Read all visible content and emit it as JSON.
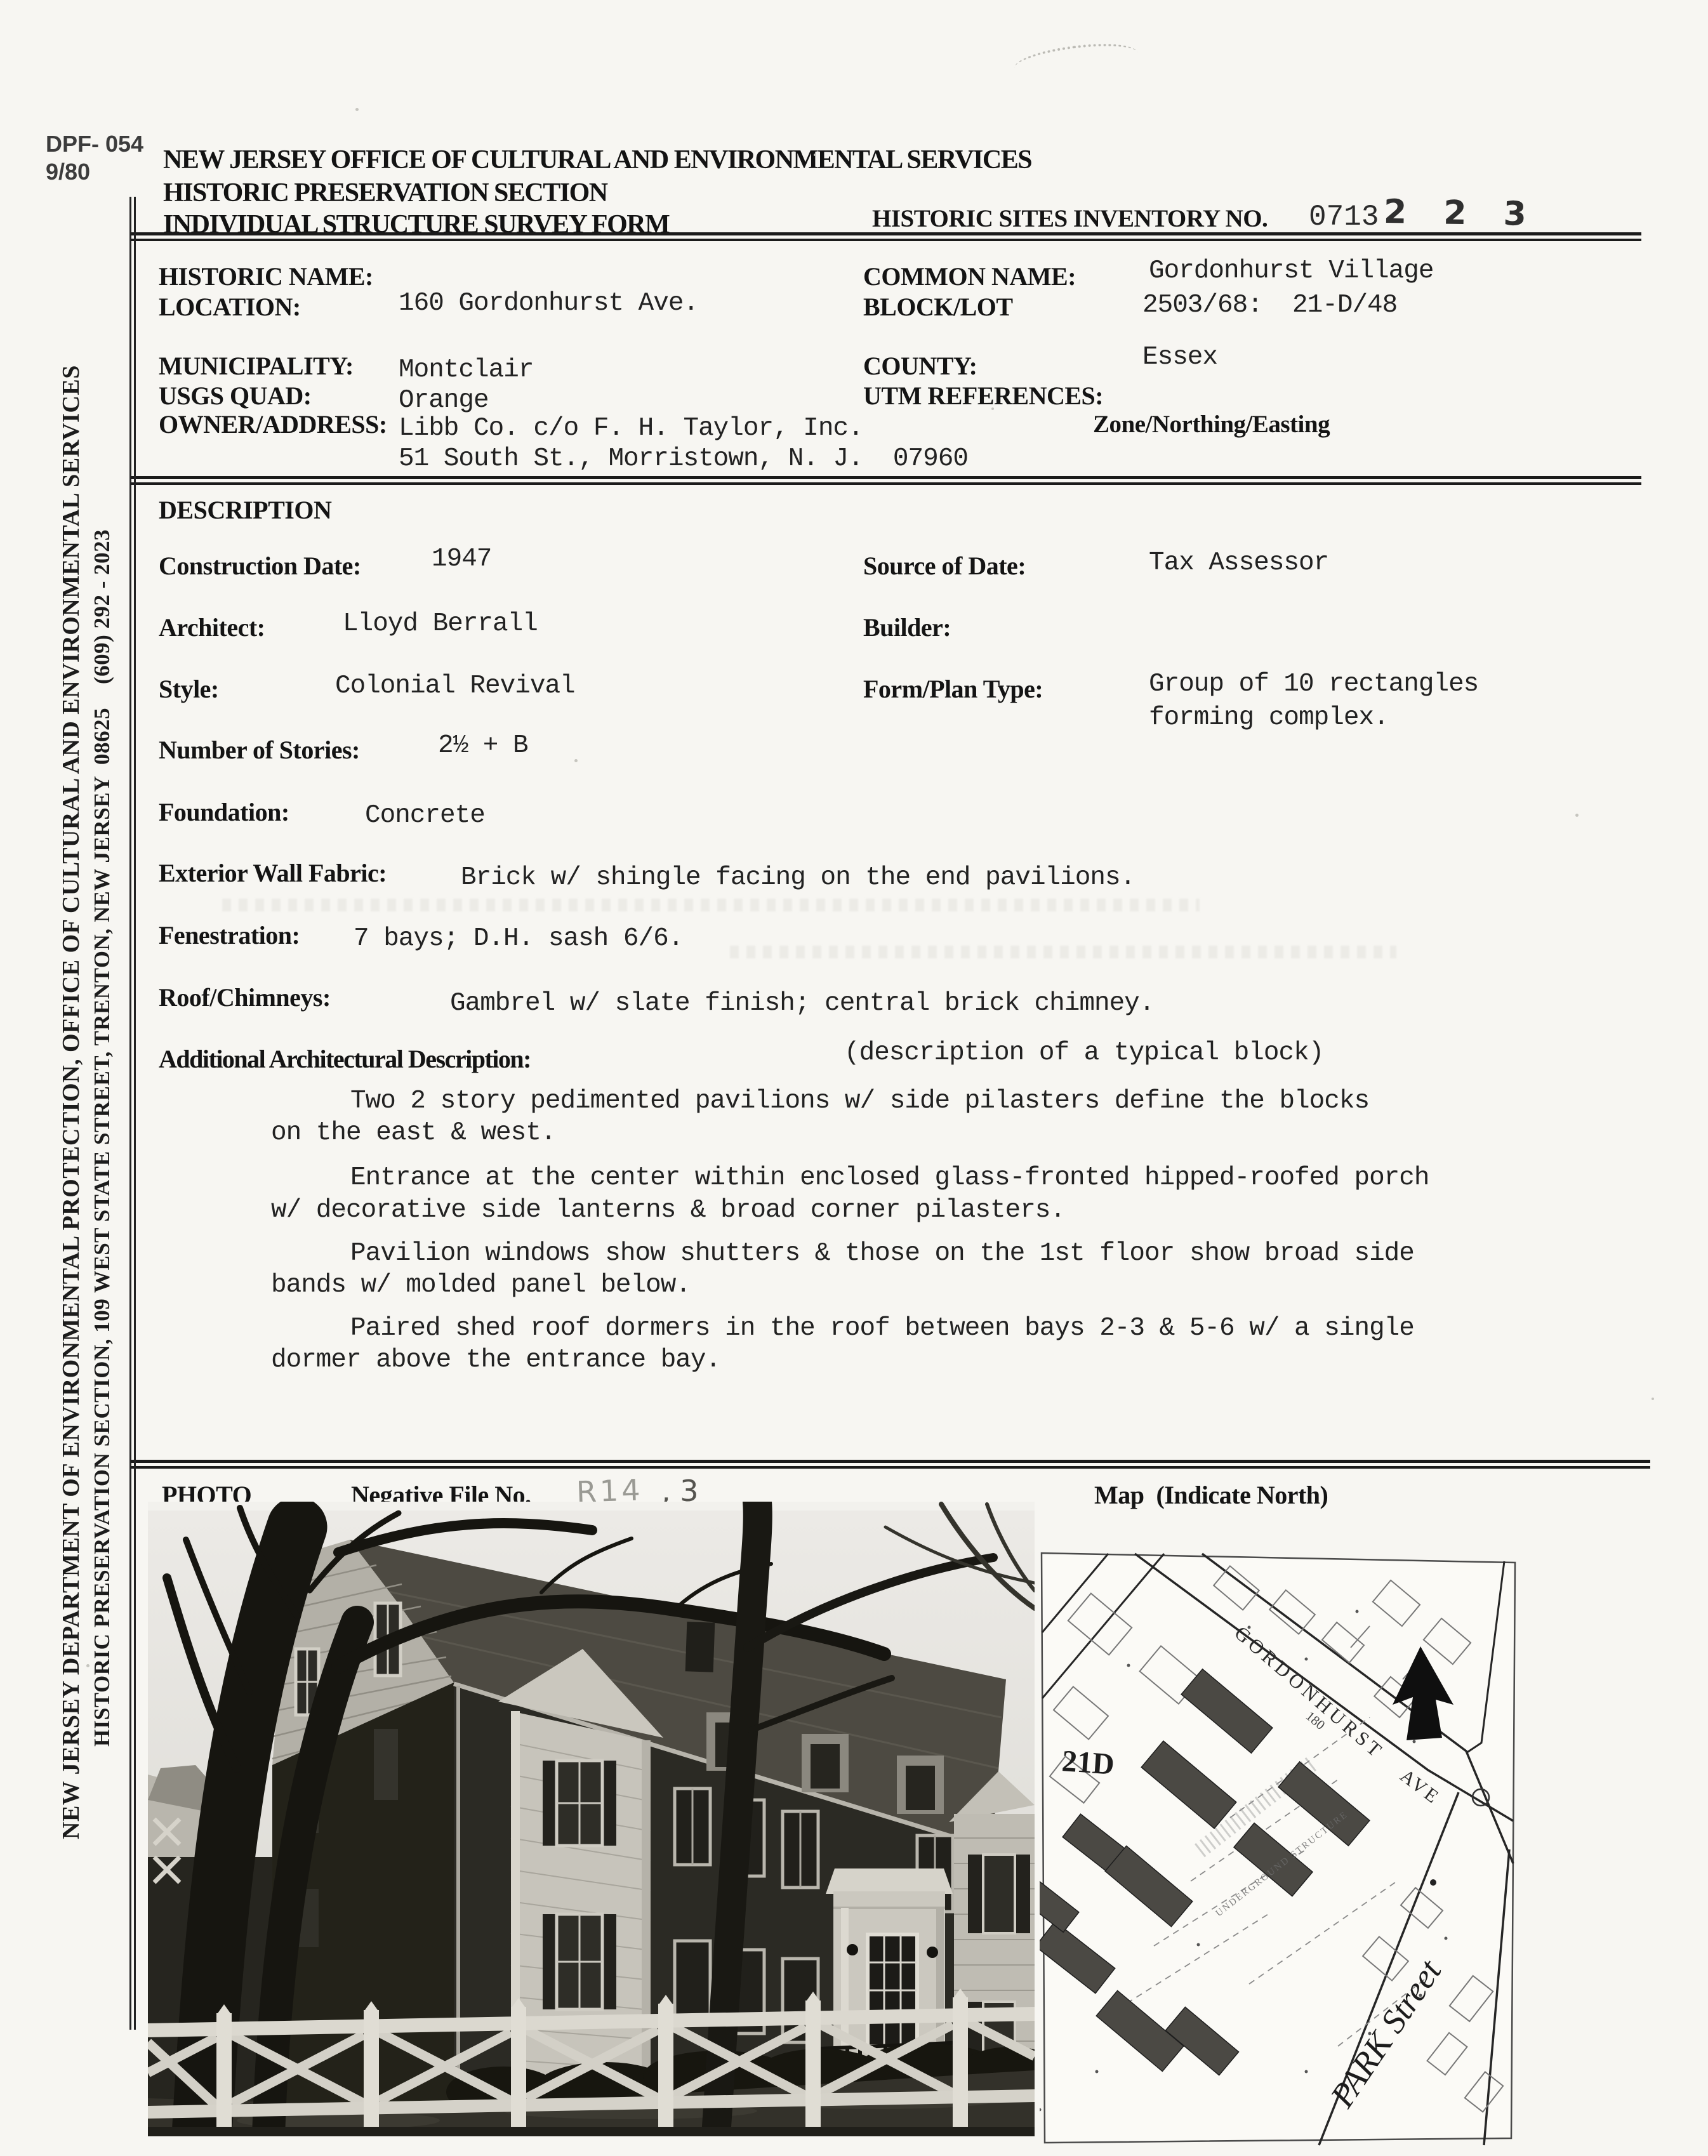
{
  "corner": {
    "code": "DPF- 054",
    "rev": "9/80"
  },
  "header": {
    "agency": "NEW JERSEY OFFICE OF CULTURAL AND ENVIRONMENTAL SERVICES",
    "section": "HISTORIC PRESERVATION SECTION",
    "form_title": "INDIVIDUAL STRUCTURE SURVEY FORM",
    "inventory_label": "HISTORIC SITES INVENTORY NO.",
    "inventory_prefix": "0713",
    "inventory_number": "2 2 3"
  },
  "sidebar": {
    "line1": "NEW JERSEY DEPARTMENT OF ENVIRONMENTAL PROTECTION, OFFICE OF CULTURAL AND ENVIRONMENTAL SERVICES",
    "line2": "HISTORIC PRESERVATION SECTION, 109 WEST STATE STREET, TRENTON, NEW JERSEY  08625    (609) 292 - 2023"
  },
  "identification": {
    "historic_name_label": "HISTORIC NAME:",
    "historic_name_value": "",
    "location_label": "LOCATION:",
    "location_value": "160 Gordonhurst Ave.",
    "common_name_label": "COMMON NAME:",
    "common_name_value": "Gordonhurst Village",
    "block_lot_label": "BLOCK/LOT",
    "block_lot_value": "2503/68:  21-D/48",
    "municipality_label": "MUNICIPALITY:",
    "municipality_value": "Montclair",
    "county_label": "COUNTY:",
    "county_value": "Essex",
    "usgs_quad_label": "USGS QUAD:",
    "usgs_quad_value": "Orange",
    "utm_label": "UTM REFERENCES:",
    "utm_sublabel": "Zone/Northing/Easting",
    "owner_label": "OWNER/ADDRESS:",
    "owner_value_line1": "Libb Co. c/o F. H. Taylor, Inc.",
    "owner_value_line2": "51 South St., Morristown, N. J.  07960"
  },
  "description": {
    "heading": "DESCRIPTION",
    "construction_date_label": "Construction Date:",
    "construction_date_value": "1947",
    "source_label": "Source of Date:",
    "source_value": "Tax Assessor",
    "architect_label": "Architect:",
    "architect_value": "Lloyd Berrall",
    "builder_label": "Builder:",
    "builder_value": "",
    "style_label": "Style:",
    "style_value": "Colonial Revival",
    "form_plan_label": "Form/Plan Type:",
    "form_plan_value_line1": "Group of 10 rectangles",
    "form_plan_value_line2": "forming complex.",
    "stories_label": "Number of Stories:",
    "stories_value": "2½ + B",
    "foundation_label": "Foundation:",
    "foundation_value": "Concrete",
    "wall_label": "Exterior Wall Fabric:",
    "wall_value": "Brick w/ shingle facing on the end pavilions.",
    "fenestration_label": "Fenestration:",
    "fenestration_value": "7 bays; D.H. sash 6/6.",
    "roof_label": "Roof/Chimneys:",
    "roof_value": "Gambrel w/ slate finish; central brick chimney.",
    "additional_label": "Additional Architectural Description:",
    "additional_note": "(description of a typical block)",
    "paragraphs": [
      [
        "Two 2 story pedimented pavilions w/ side pilasters define the blocks",
        "on the east & west."
      ],
      [
        "Entrance at the center within enclosed glass-fronted hipped-roofed porch",
        "w/ decorative side lanterns & broad corner pilasters."
      ],
      [
        "Pavilion windows show shutters & those on the 1st floor show broad side",
        "bands w/ molded panel below."
      ],
      [
        "Paired shed roof dormers in the roof between bays 2-3 & 5-6 w/ a single",
        "dormer above the entrance bay."
      ]
    ]
  },
  "photo_section": {
    "photo_label": "PHOTO",
    "negative_label": "Negative File No.",
    "negative_value_hand": "R14",
    "negative_value_typed": ", 3",
    "map_label": "Map  (Indicate North)"
  },
  "map": {
    "street_gordonhurst": "GORDONHURST",
    "street_ave": "AVE",
    "street_park": "PARK Street",
    "block_label": "21D",
    "address_label": "180",
    "underground_label": "UNDERGROUND STRUCTURE"
  }
}
